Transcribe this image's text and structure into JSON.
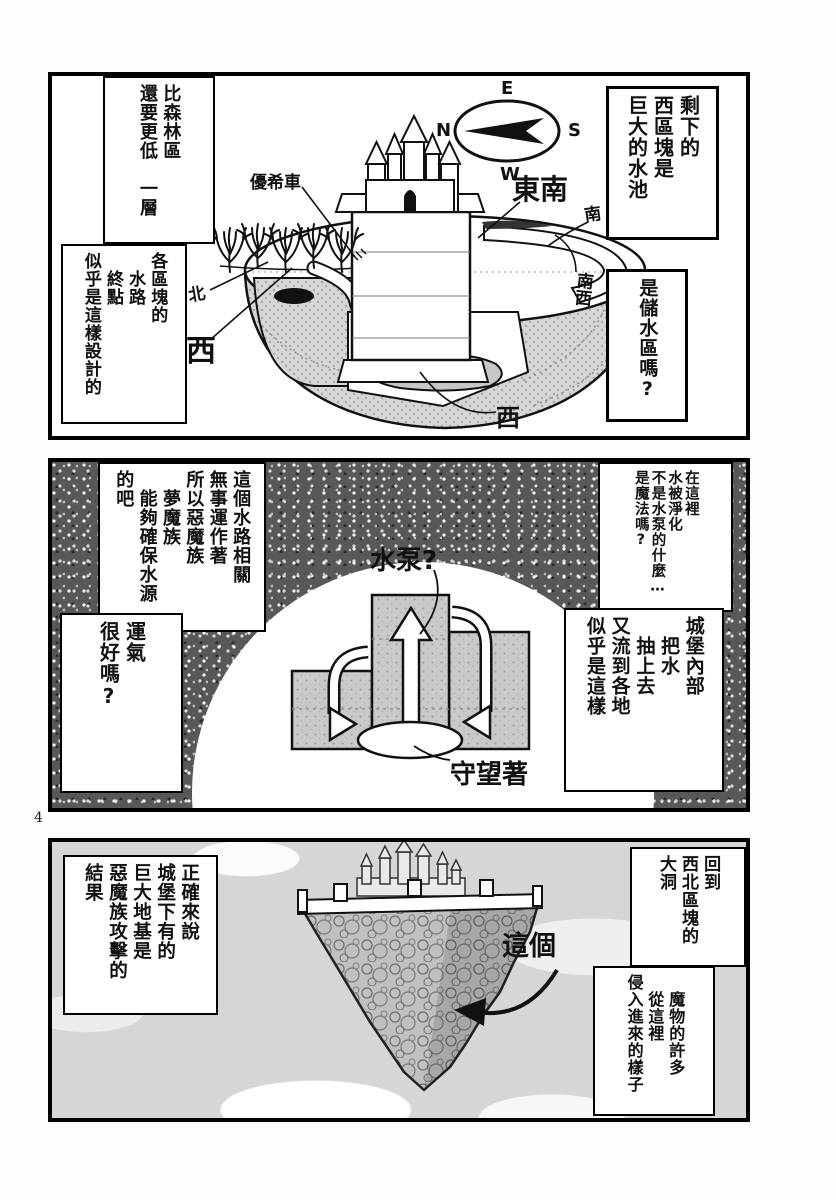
{
  "page_number": "4",
  "colors": {
    "ink": "#111111",
    "paper": "#ffffff",
    "tone_gray": "#c9c9c9",
    "sky_gray": "#d6d6d6"
  },
  "panel1": {
    "compass": {
      "n": "N",
      "e": "E",
      "s": "S",
      "w": "W"
    },
    "labels": {
      "cart": "優希車",
      "southeast": "東南",
      "south": "南",
      "southwest": "南西",
      "west_bottom": "西",
      "north": "北",
      "west_left": "西"
    },
    "bubbles": {
      "left_top": "比森林區\n還要更低　一層",
      "left_bottom": "各區塊的\n　水路\n　終點\n似乎是這樣設計的",
      "right_top": "剩下的\n西區塊是\n巨大的水池",
      "right_bottom": "是儲水區嗎?"
    }
  },
  "panel2": {
    "labels": {
      "pump": "水泵?",
      "watching": "守望著"
    },
    "bubbles": {
      "left_top": "這個水路相關\n無事運作著\n所以惡魔族\n　夢魔族\n　能夠確保水源\n的吧",
      "left_bottom": "運氣\n很好嗎?",
      "right_top": "在這裡\n水被淨化\n不是水泵的什麼…\n是魔法嗎?",
      "right_bottom": "城堡內部\n　把水\n　抽上去\n又流到各地\n似乎是這樣"
    }
  },
  "panel3": {
    "labels": {
      "this_one": "這個"
    },
    "bubbles": {
      "left": "正確來說\n城堡下有的\n巨大地基是\n惡魔族攻擊的\n結果",
      "right_top": "回到\n西北區塊的\n大洞",
      "right_bottom": "　魔物的許多\n　從這裡\n侵入進來的樣子"
    }
  }
}
